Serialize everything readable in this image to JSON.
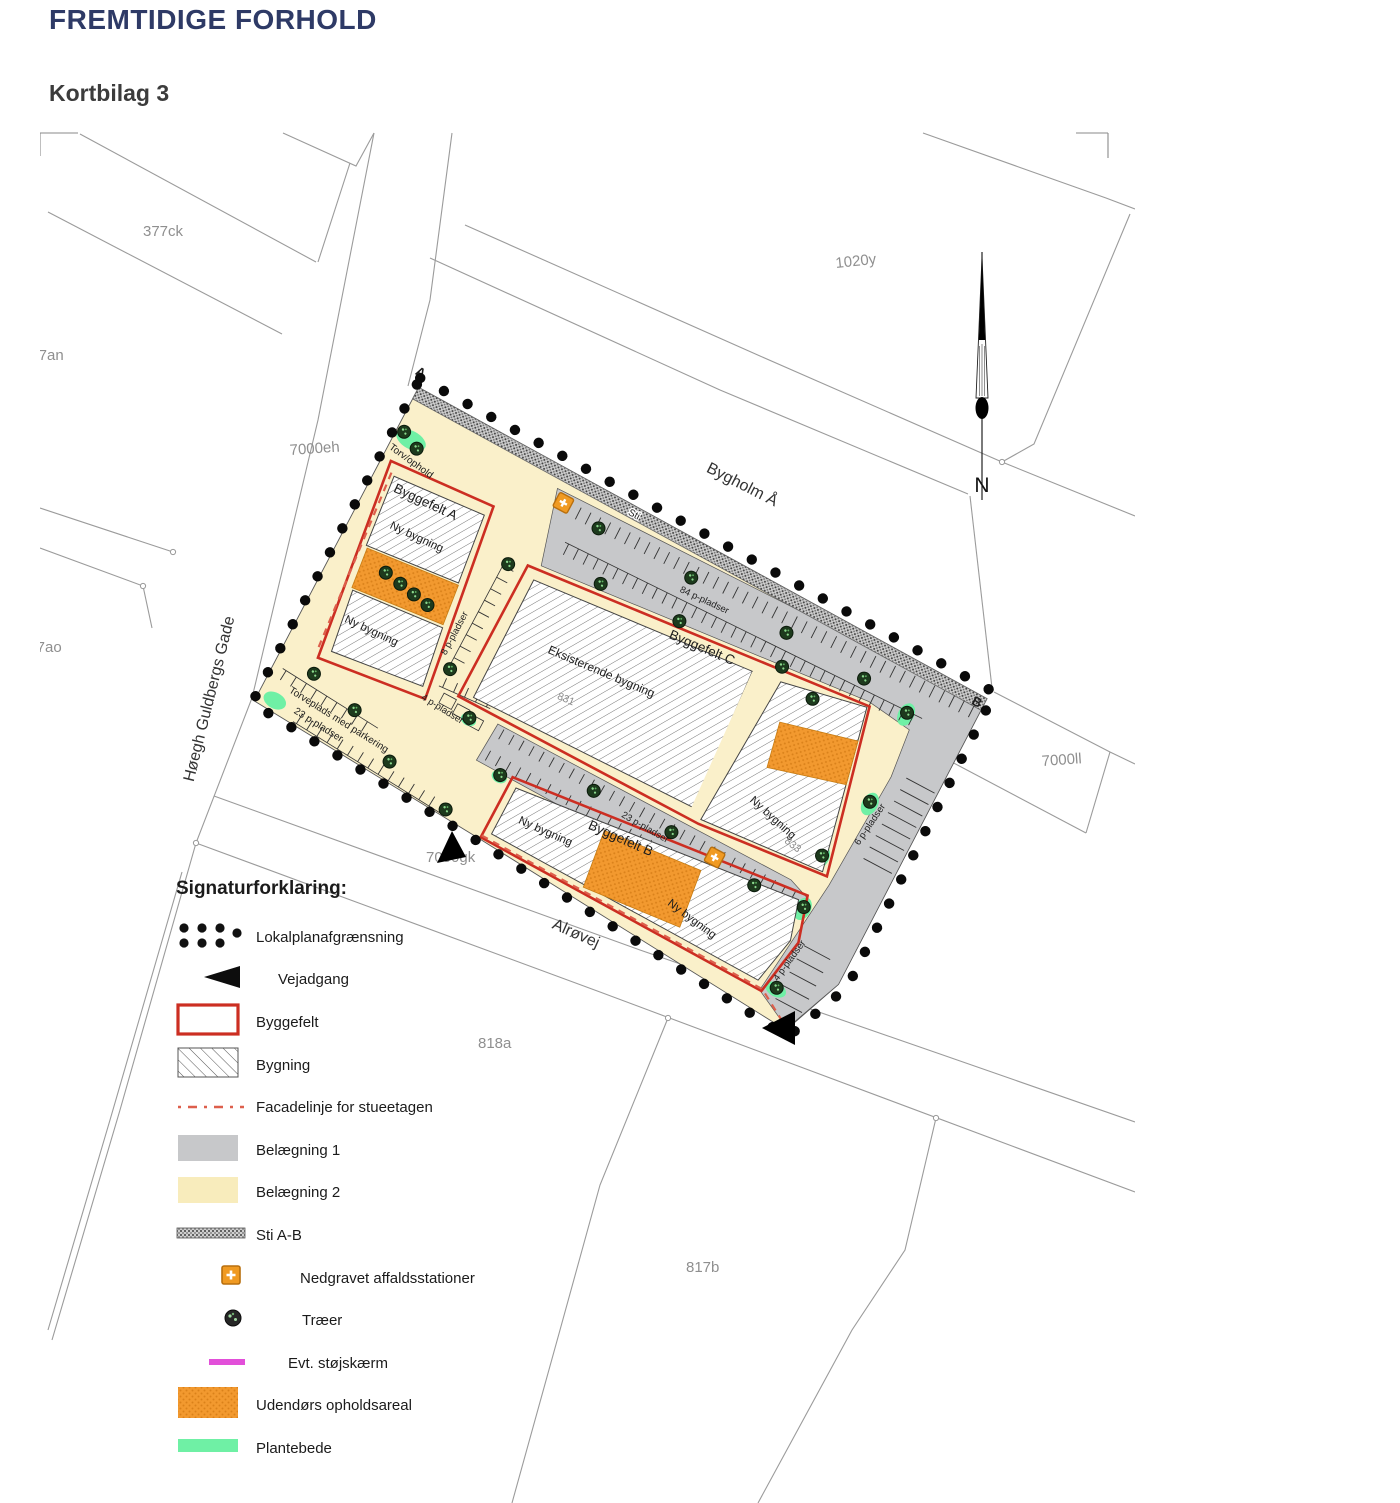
{
  "page": {
    "title": "FREMTIDIGE FORHOLD",
    "subtitle": "Kortbilag 3"
  },
  "legend": {
    "heading": "Signaturforklaring:",
    "items": [
      {
        "id": "lokalplan",
        "icon": "boundary-dots-icon",
        "label": "Lokalplanafgrænsning"
      },
      {
        "id": "vejadgang",
        "icon": "road-access-triangle-icon",
        "label": "Vejadgang"
      },
      {
        "id": "byggefelt",
        "icon": "red-outline-rect-icon",
        "label": "Byggefelt"
      },
      {
        "id": "bygning",
        "icon": "hatched-rect-icon",
        "label": "Bygning"
      },
      {
        "id": "facadelinje",
        "icon": "red-dashed-line-icon",
        "label": "Facadelinje for stueetagen"
      },
      {
        "id": "belaegning1",
        "icon": "gray-swatch-icon",
        "label": "Belægning 1"
      },
      {
        "id": "belaegning2",
        "icon": "cream-swatch-icon",
        "label": "Belægning 2"
      },
      {
        "id": "sti",
        "icon": "path-band-icon",
        "label": "Sti A-B"
      },
      {
        "id": "affald",
        "icon": "waste-station-icon",
        "label": "Nedgravet affaldsstationer"
      },
      {
        "id": "traeer",
        "icon": "tree-icon",
        "label": "Træer"
      },
      {
        "id": "stoejskaerm",
        "icon": "magenta-line-icon",
        "label": "Evt. støjskærm"
      },
      {
        "id": "opholdsareal",
        "icon": "orange-swatch-icon",
        "label": "Udendørs opholdsareal"
      },
      {
        "id": "plantebede",
        "icon": "green-swatch-icon",
        "label": "Plantebede"
      }
    ]
  },
  "map": {
    "north": "N",
    "points": {
      "a": "A",
      "b": "B"
    },
    "streets": {
      "hoegh": "Høegh Guldbergs Gade",
      "bygholm": "Bygholm Å",
      "alroevej": "Alrøvej"
    },
    "parcels": {
      "p377ck": "377ck",
      "p377an": "377an",
      "p377ao": "377ao",
      "p7000eh": "7000eh",
      "p1020y": "1020y",
      "p7000ll": "7000ll",
      "p7000gk": "7000gk",
      "p818a": "818a",
      "p817b": "817b"
    },
    "site": {
      "sti": "Sti",
      "torv": "Torv/ophold",
      "torveplads_line1": "Torveplads med parkering",
      "torveplads_line2": "23 p-pladser",
      "byggefelt_a": "Byggefelt A",
      "byggefelt_b": "Byggefelt B",
      "byggefelt_c": "Byggefelt C",
      "ny_bygning": "Ny bygning",
      "eksisterende_bygning": "Eksisterende bygning",
      "num_831": "831",
      "num_833": "833",
      "p84": "84 p-pladser",
      "p23": "23 p-pladser",
      "p8": "8 p-pladser",
      "p6": "6 p-pladser",
      "p4": "4 p-pladser"
    }
  },
  "colors": {
    "title_navy": "#2E3A66",
    "byggefelt_red": "#CC2E22",
    "facade_red": "#DD5F4C",
    "belaegning1_gray": "#C7C8CA",
    "belaegning2_cream": "#FAF0CA",
    "opholdsareal_orange": "#F2992F",
    "plantebede_green": "#6FF0A5",
    "stoejskaerm_magenta": "#E24FD9",
    "affald_orange": "#F09A22"
  }
}
